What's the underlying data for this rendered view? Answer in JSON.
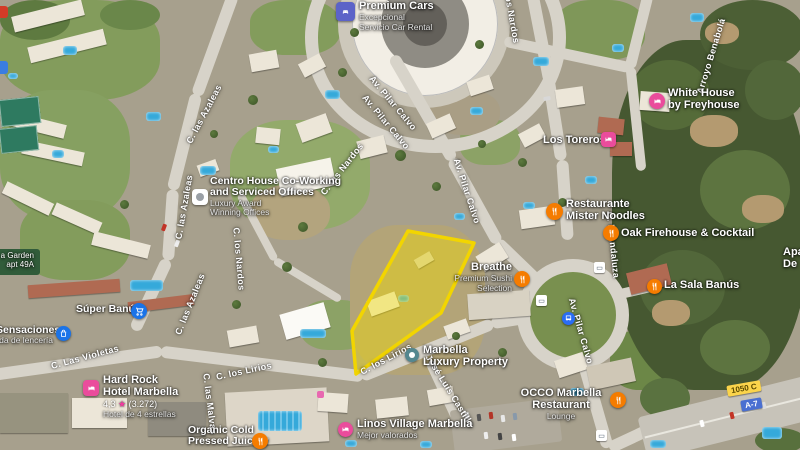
{
  "pois": {
    "premium_cars": {
      "name": "Premium Cars",
      "sub1": "Excepcional",
      "sub2": "Servicio Car Rental"
    },
    "centro_house": {
      "line1": "Centro House Co-Working",
      "line2": "and Serviced Offices",
      "sub1": "Luxury Award",
      "sub2": "Winning Offices"
    },
    "white_house": {
      "line1": "White House",
      "line2": "by Freyhouse"
    },
    "los_toreros": {
      "name": "Los Toreros"
    },
    "mister_noodles": {
      "line1": "Restaurante",
      "line2": "Mister Noodles"
    },
    "oak_firehouse": {
      "name": "Oak Firehouse & Cocktail"
    },
    "la_sala_banus": {
      "name": "La Sala Banús"
    },
    "breathe": {
      "name": "Breathe",
      "sub1": "Premium Sushi",
      "sub2": "Selection"
    },
    "super_banus": {
      "name": "Súper Banús"
    },
    "las_sensaciones": {
      "name": "Las Sensaciones",
      "sub": "Tienda de lencería"
    },
    "hard_rock": {
      "line1": "Hard Rock",
      "line2": "Hotel Marbella",
      "rating": "4,3",
      "star": "★",
      "reviews": "(3.272)",
      "sub": "Hotel de 4 estrellas"
    },
    "marbella_luxury": {
      "line1": "Marbella",
      "line2": "Luxury Property"
    },
    "linos_village": {
      "name": "Linos Village Marbella",
      "sub": "Mejor valorados"
    },
    "occo": {
      "line1": "OCCO Marbella",
      "line2": "Restaurant",
      "line3": "Lounge"
    },
    "organic_juicery": {
      "line1": "Organic Cold",
      "line2": "Pressed Juicery"
    },
    "apartments_edge": {
      "line1": "Apartamentos",
      "line2": "De"
    },
    "garden_apartments": {
      "line1": "a Garden",
      "line2": "apt 49A"
    }
  },
  "streets": [
    {
      "text": "Av. Pilar Calvo"
    },
    {
      "text": "Av. Pilar Calvo"
    },
    {
      "text": "Av. Pilar Calvo"
    },
    {
      "text": "Av. Pilar Calvo"
    },
    {
      "text": "C. las Azaleas"
    },
    {
      "text": "C. las Azaleas"
    },
    {
      "text": "C. las Azaleas"
    },
    {
      "text": "C. los Nardos"
    },
    {
      "text": "C. los Nardos"
    },
    {
      "text": "C. los Nardos"
    },
    {
      "text": "C. Las Violetas"
    },
    {
      "text": "C. los Lirios"
    },
    {
      "text": "C. los Lirios"
    },
    {
      "text": "José Luis Castillo"
    },
    {
      "text": "C. las Malvas"
    },
    {
      "text": "Arroyo Benabolá"
    },
    {
      "text": "C. la Andaluza"
    }
  ],
  "road_badges": {
    "regional": "1050 C",
    "highway": "A-7"
  },
  "colors": {
    "parcel_outline": "#f2d500",
    "parcel_fill": "rgba(244,221,0,0.42)",
    "restaurant_icon": "#f57c00",
    "lodging_icon": "#ea4c9c",
    "shopping_icon": "#1a73e8",
    "car_rental_icon": "#5c63c8",
    "realty_icon": "#53878f",
    "regional_badge": "#fbd44b",
    "highway_badge": "#4a6fd1",
    "forest": "#465831",
    "road": "#d7d3c9"
  }
}
